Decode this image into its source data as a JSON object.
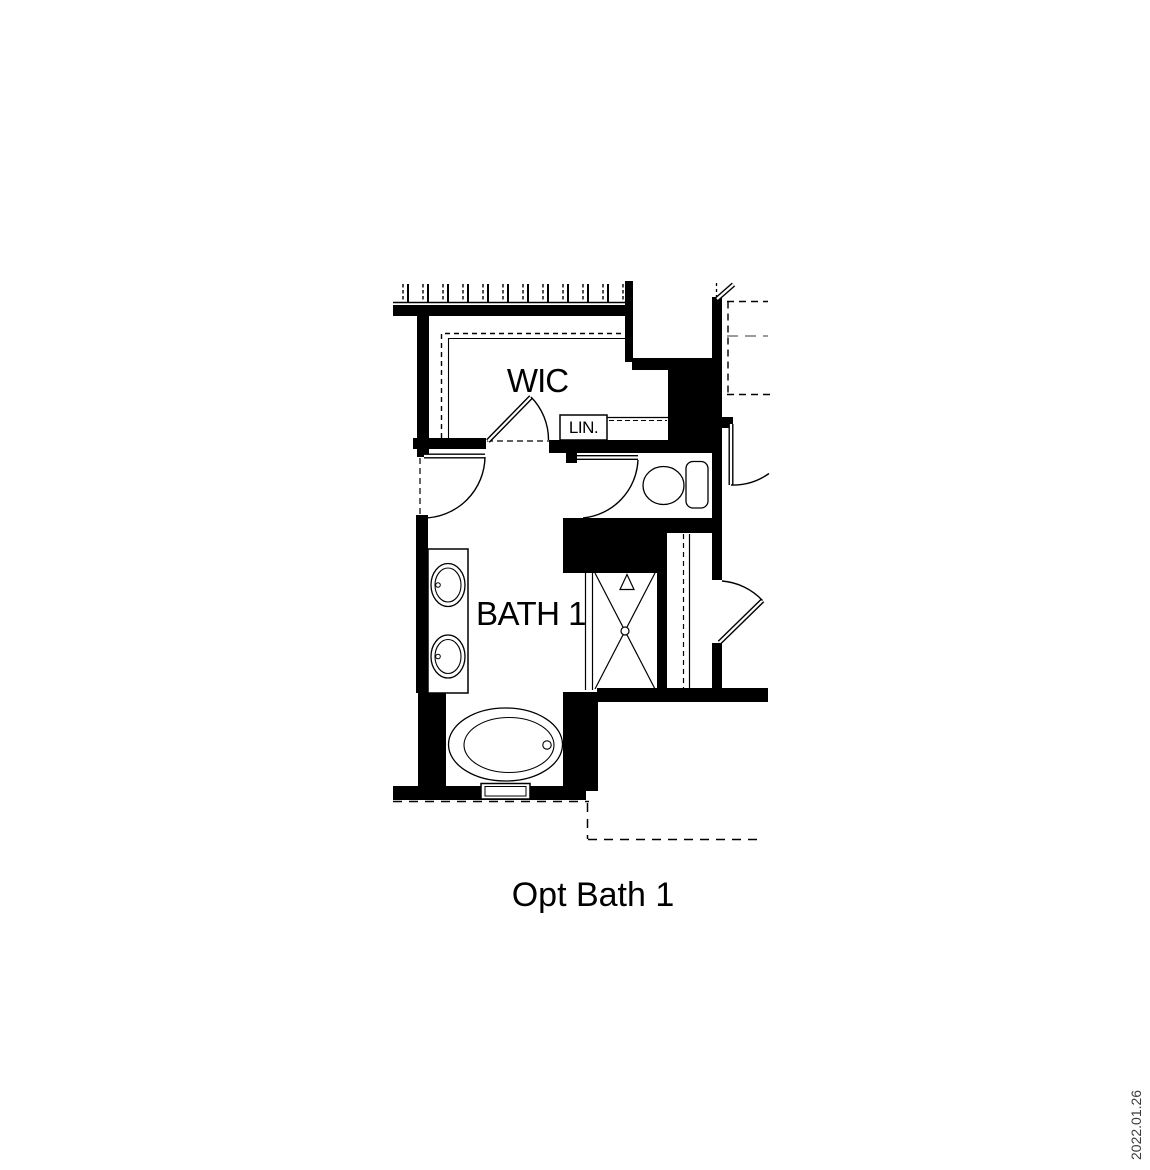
{
  "colors": {
    "ink": "#000000",
    "paper": "#ffffff",
    "dash_muted": "#7a7a7a",
    "revision_text": "#3a3a3a"
  },
  "floorplan": {
    "caption": "Opt Bath 1",
    "rooms": [
      {
        "id": "wic",
        "label": "WIC"
      },
      {
        "id": "bath-1",
        "label": "BATH 1"
      },
      {
        "id": "linen-closet",
        "label": "LIN."
      }
    ],
    "fixtures": [
      {
        "id": "double-vanity-sinks"
      },
      {
        "id": "toilet"
      },
      {
        "id": "walk-in-shower"
      },
      {
        "id": "oval-bathtub"
      },
      {
        "id": "closet-rod-hatching"
      },
      {
        "id": "door-swings"
      }
    ]
  },
  "annotations": {
    "revision_date": "2022.01.26"
  }
}
